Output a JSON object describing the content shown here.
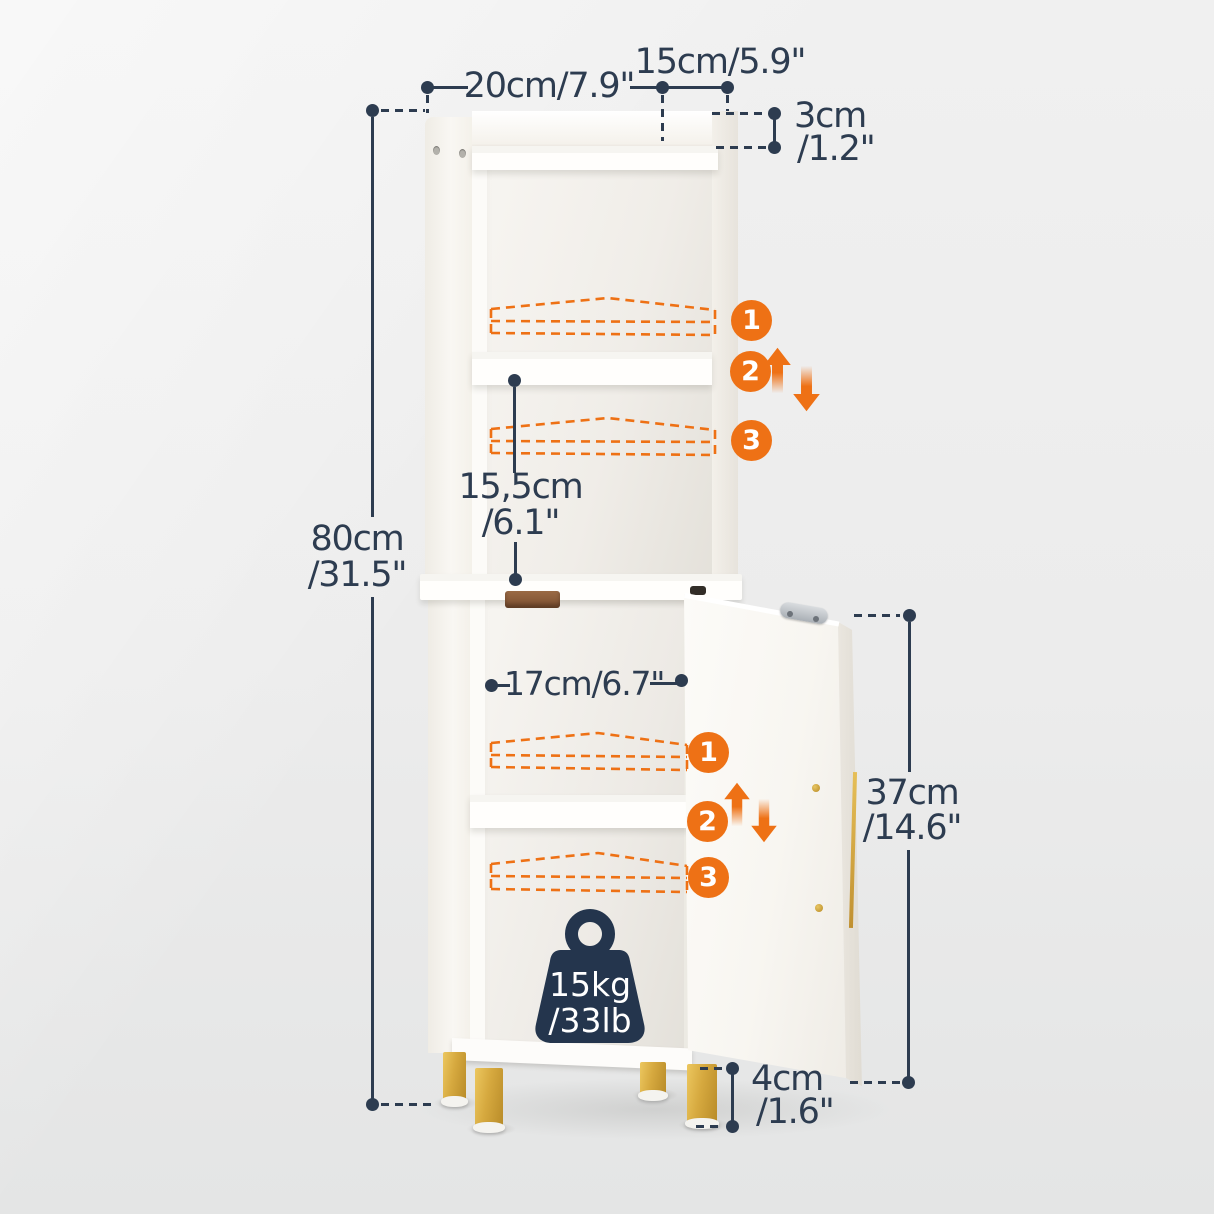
{
  "dimensions": {
    "top_width": "20cm/7.9\"",
    "top_depth": "15cm/5.9\"",
    "top_lip": {
      "line1": "3cm",
      "line2": "/1.2\""
    },
    "overall_height": {
      "line1": "80cm",
      "line2": "/31.5\""
    },
    "shelf_spacing": {
      "line1": "15,5cm",
      "line2": "/6.1\""
    },
    "inner_width": "17cm/6.7\"",
    "door_height": {
      "line1": "37cm",
      "line2": "/14.6\""
    },
    "leg_height": {
      "line1": "4cm",
      "line2": "/1.6\""
    }
  },
  "capacity": {
    "line1": "15kg",
    "line2": "/33lb"
  },
  "adjustable_positions": {
    "upper": [
      "1",
      "2",
      "3"
    ],
    "lower": [
      "1",
      "2",
      "3"
    ]
  },
  "colors": {
    "accent_orange": "#ee7115",
    "annotation_navy": "#2d3c50",
    "gold": "#d6a93f",
    "background": "#ececec",
    "cabinet_white": "#faf8f4"
  }
}
